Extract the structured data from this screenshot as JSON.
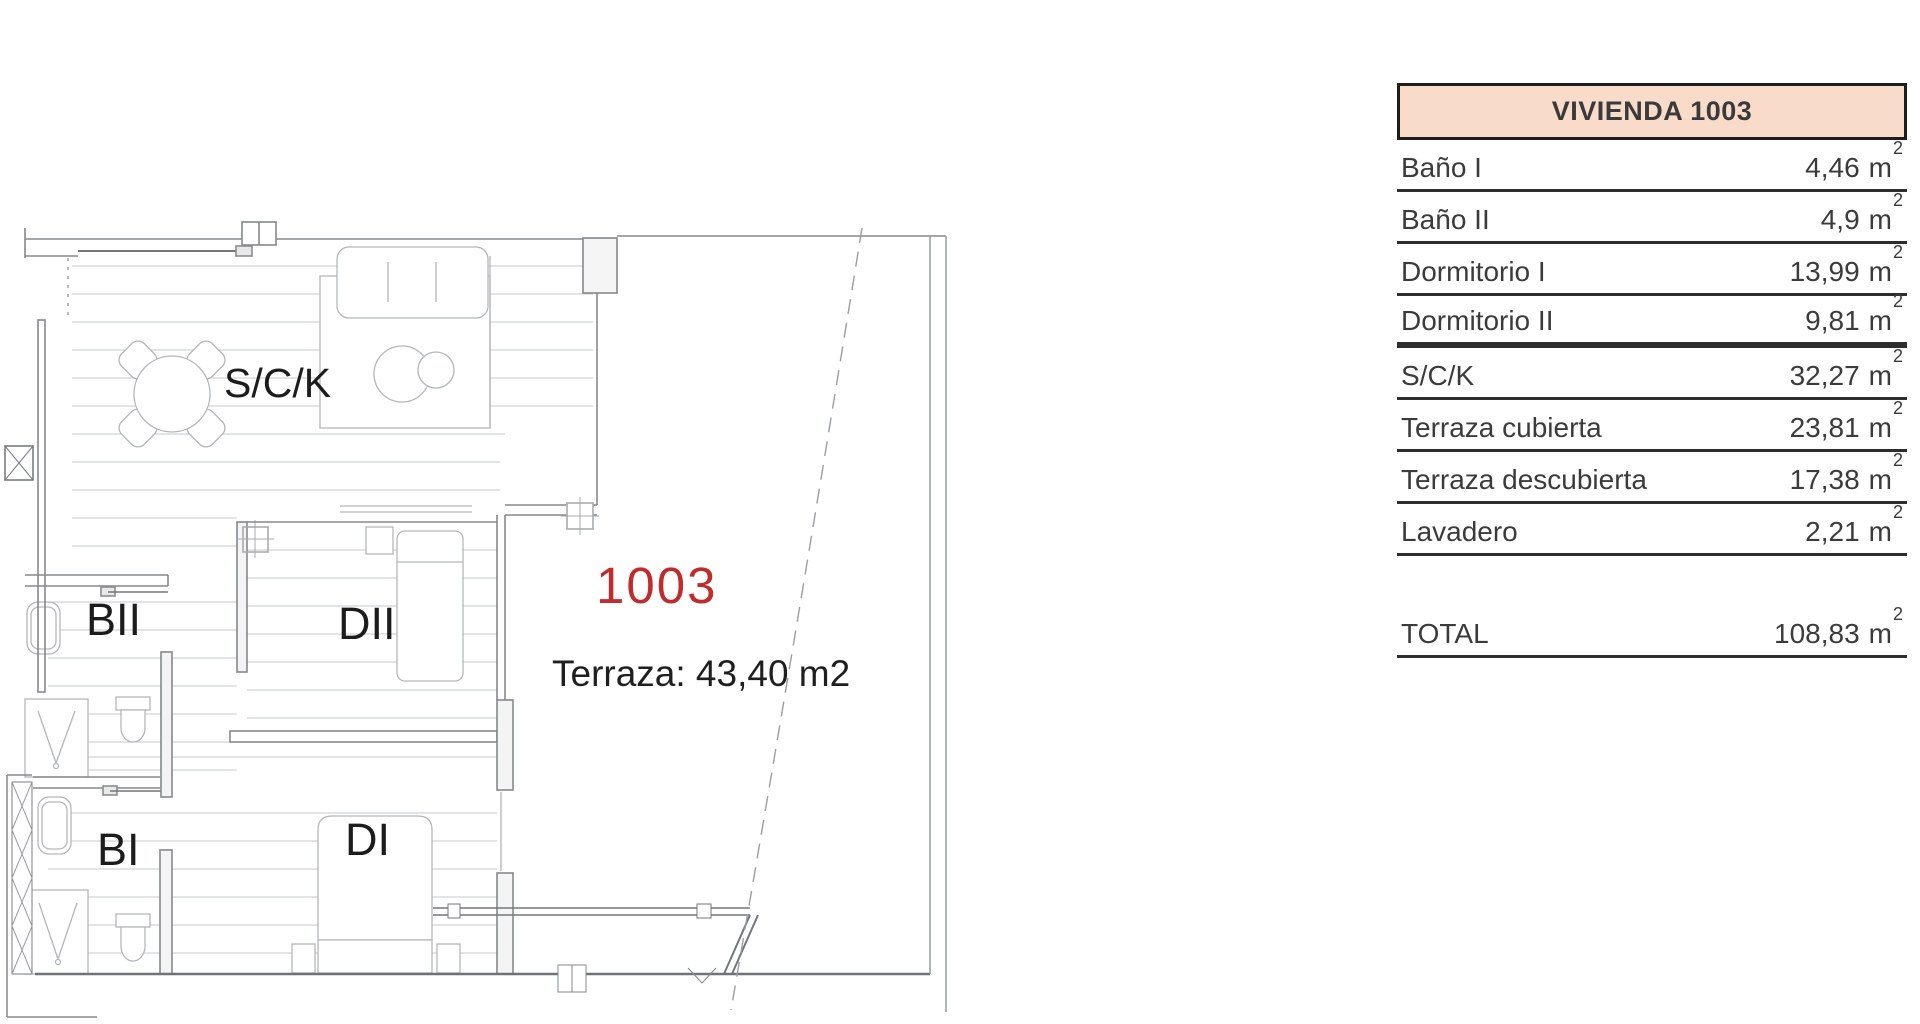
{
  "plan": {
    "unit_number": "1003",
    "unit_number_color": "#bf2c2e",
    "terrace_note": "Terraza: 43,40 m2",
    "room_labels": {
      "sck": "S/C/K",
      "banio2": "BII",
      "dorm2": "DII",
      "banio1": "BI",
      "dorm1": "DI"
    }
  },
  "table": {
    "title": "VIVIENDA 1003",
    "header_bg": "#f9dbca",
    "rows": [
      {
        "label": "Baño I",
        "value": "4,46"
      },
      {
        "label": "Baño II",
        "value": "4,9"
      },
      {
        "label": "Dormitorio I",
        "value": "13,99"
      },
      {
        "label": "Dormitorio II",
        "value": "9,81"
      },
      {
        "label": "S/C/K",
        "value": "32,27"
      },
      {
        "label": "Terraza cubierta",
        "value": "23,81"
      },
      {
        "label": "Terraza descubierta",
        "value": "17,38"
      },
      {
        "label": "Lavadero",
        "value": "2,21"
      }
    ],
    "total": {
      "label": "TOTAL",
      "value": "108,83"
    },
    "units": {
      "base": "m",
      "sup": "2"
    }
  }
}
